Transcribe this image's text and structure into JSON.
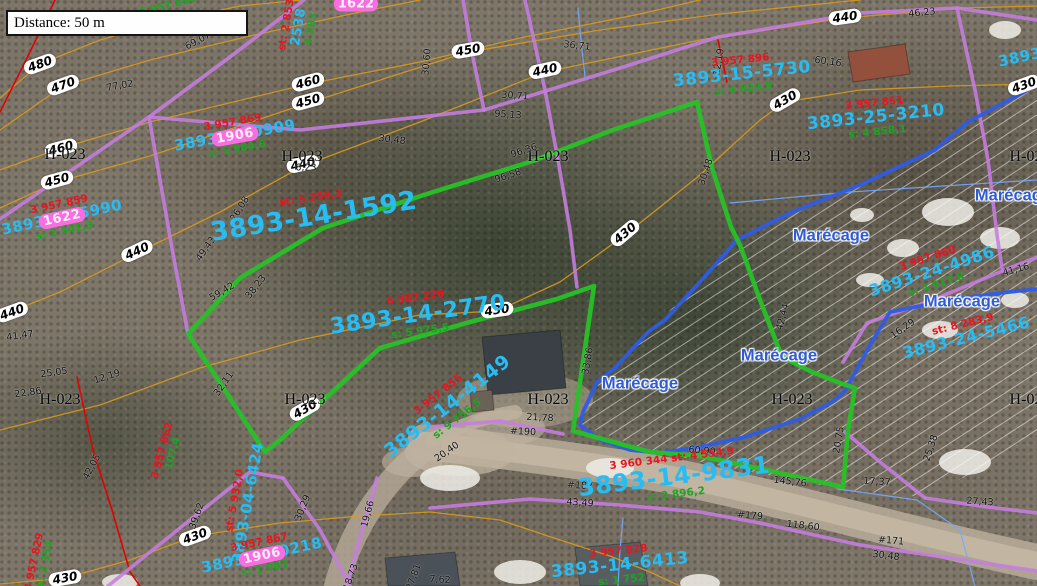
{
  "scale_box": {
    "label": "Distance: 50 m"
  },
  "map": {
    "zone_text": "H-023",
    "wetland_text": "Marécage",
    "colors": {
      "contour": "#d79a1e",
      "cadastral": "#c67de0",
      "parcel_green": "#27c127",
      "wetland_blue": "#2e5ce6",
      "stream": "#74a9ff",
      "red_line": "#e40000",
      "lot_cyan": "#27bdf4",
      "lot_red": "#ea1420",
      "area_green": "#1da522",
      "badge_pink": "#f86ee0",
      "road": "#b5a997"
    },
    "zone_labels": [
      [
        65,
        155
      ],
      [
        302,
        157
      ],
      [
        548,
        157
      ],
      [
        790,
        157
      ],
      [
        1030,
        157
      ],
      [
        60,
        400
      ],
      [
        305,
        400
      ],
      [
        548,
        400
      ],
      [
        792,
        400
      ],
      [
        1030,
        400
      ]
    ],
    "wetland_labels": [
      [
        640,
        384
      ],
      [
        779,
        356
      ],
      [
        831,
        236
      ],
      [
        962,
        302
      ],
      [
        1013,
        196
      ]
    ],
    "contour_labels": [
      [
        "480",
        40,
        64,
        -20
      ],
      [
        "480",
        163,
        22,
        -12
      ],
      [
        "470",
        63,
        85,
        -20
      ],
      [
        "460",
        308,
        82,
        -15
      ],
      [
        "460",
        61,
        148,
        -15
      ],
      [
        "450",
        468,
        50,
        -10
      ],
      [
        "450",
        308,
        101,
        -15
      ],
      [
        "450",
        57,
        180,
        -15
      ],
      [
        "440",
        845,
        17,
        -8
      ],
      [
        "440",
        545,
        70,
        -12
      ],
      [
        "440",
        303,
        164,
        -12
      ],
      [
        "440",
        137,
        251,
        -25
      ],
      [
        "440",
        12,
        312,
        -20
      ],
      [
        "430",
        785,
        100,
        -30
      ],
      [
        "430",
        625,
        233,
        -40
      ],
      [
        "430",
        497,
        310,
        -8
      ],
      [
        "430",
        305,
        409,
        -30
      ],
      [
        "430",
        195,
        536,
        -20
      ],
      [
        "430",
        65,
        578,
        -10
      ],
      [
        "430",
        1024,
        85,
        -20
      ]
    ],
    "measure_labels": [
      [
        "69,07",
        198,
        41,
        -28
      ],
      [
        "77,02",
        120,
        86,
        -10
      ],
      [
        "36,71",
        577,
        46,
        6
      ],
      [
        "30,71",
        515,
        96,
        4
      ],
      [
        "95,13",
        508,
        115,
        4
      ],
      [
        "30,48",
        392,
        140,
        7
      ],
      [
        "30,60",
        427,
        62,
        -85
      ],
      [
        "46,23",
        922,
        13,
        -6
      ],
      [
        "60,16",
        828,
        62,
        8
      ],
      [
        "12,19",
        719,
        62,
        -80
      ],
      [
        "30,48",
        706,
        172,
        -72
      ],
      [
        "96,36",
        524,
        151,
        -18
      ],
      [
        "96,58",
        508,
        176,
        -18
      ],
      [
        "6,23",
        306,
        168,
        0
      ],
      [
        "26,08",
        240,
        209,
        -58
      ],
      [
        "49,43",
        206,
        249,
        -55
      ],
      [
        "38,23",
        256,
        287,
        -52
      ],
      [
        "59,42",
        222,
        292,
        -30
      ],
      [
        "41,47",
        20,
        336,
        -8
      ],
      [
        "25,05",
        54,
        373,
        -8
      ],
      [
        "12,19",
        107,
        377,
        -18
      ],
      [
        "22,86",
        28,
        393,
        -8
      ],
      [
        "32,11",
        224,
        384,
        -55
      ],
      [
        "42,05",
        92,
        467,
        -62
      ],
      [
        "39,62",
        197,
        516,
        -70
      ],
      [
        "30,29",
        303,
        508,
        -68
      ],
      [
        "19,66",
        368,
        514,
        -75
      ],
      [
        "18,73",
        351,
        577,
        -70
      ],
      [
        "27,81",
        414,
        577,
        -70
      ],
      [
        "43,49",
        580,
        503,
        4
      ],
      [
        "21,78",
        540,
        418,
        3
      ],
      [
        "#190",
        523,
        432,
        3
      ],
      [
        "20,40",
        447,
        452,
        -35
      ],
      [
        "33,86",
        588,
        361,
        -80
      ],
      [
        "60,90",
        702,
        451,
        5
      ],
      [
        "145,76",
        790,
        482,
        7
      ],
      [
        "17,37",
        877,
        482,
        4
      ],
      [
        "27,43",
        980,
        502,
        4
      ],
      [
        "118,60",
        803,
        526,
        7
      ],
      [
        "30,48",
        886,
        556,
        7
      ],
      [
        "#171",
        891,
        541,
        5
      ],
      [
        "#187",
        580,
        486,
        4
      ],
      [
        "#179",
        750,
        516,
        4
      ],
      [
        "20,75",
        839,
        440,
        -80
      ],
      [
        "25,38",
        931,
        448,
        -72
      ],
      [
        "41,16",
        1016,
        270,
        -16
      ],
      [
        "16,29",
        903,
        329,
        -35
      ],
      [
        "42,44",
        783,
        317,
        -75
      ],
      [
        "7,62",
        440,
        580,
        4
      ]
    ],
    "parcel_labels": [
      {
        "x": 313,
        "y": 212,
        "rot": -9,
        "size": 26,
        "red": "st: 5 258,3",
        "cyan": "3893-14-1592"
      },
      {
        "x": 418,
        "y": 315,
        "rot": -8,
        "size": 22,
        "red": "6 387 226",
        "cyan": "3893-14-2770",
        "green": "s: 5 975,5"
      },
      {
        "x": 448,
        "y": 407,
        "rot": -38,
        "size": 19,
        "red": "3 957 855",
        "cyan": "3893-14-4149",
        "green": "s: 9 756,5"
      },
      {
        "x": 674,
        "y": 477,
        "rot": -7,
        "size": 24,
        "red": "3 960 344   st: 4 554,9",
        "cyan": "3893-14-9831",
        "green": "s: 2 896,2"
      },
      {
        "x": 620,
        "y": 566,
        "rot": -6,
        "size": 17,
        "red": "3 957 828",
        "cyan": "3893-14-6413",
        "green": "s: 1 752"
      },
      {
        "x": 742,
        "y": 75,
        "rot": -6,
        "size": 17,
        "red": "3 957 896",
        "cyan": "3893-15-5730",
        "green": "s: 4 929,9"
      },
      {
        "x": 876,
        "y": 118,
        "rot": -6,
        "size": 17,
        "red": "3 957 851",
        "cyan": "3893-25-3210",
        "green": "s: 4 858,1"
      },
      {
        "x": 932,
        "y": 272,
        "rot": -18,
        "size": 16,
        "red": "3 957 860",
        "cyan": "3893-24-4986",
        "green": "s: 4 917,8"
      },
      {
        "x": 965,
        "y": 333,
        "rot": -14,
        "size": 16,
        "red": "st: 8 283,9",
        "cyan": "3893-24-5466"
      },
      {
        "x": 243,
        "y": 502,
        "rot": -80,
        "size": 15,
        "red": "st: 5 932,0",
        "cyan": "3893-04-6424"
      },
      {
        "x": 62,
        "y": 218,
        "rot": -12,
        "size": 15,
        "red": "3 957 859",
        "cyan": "3893-04-5990",
        "green": "s: 2 341,3",
        "badge": "1622"
      },
      {
        "x": 235,
        "y": 136,
        "rot": -10,
        "size": 15,
        "red": "3 957 869",
        "cyan": "3893-15-0909",
        "green": "s: 5 984,6",
        "badge": "1906"
      },
      {
        "x": 262,
        "y": 556,
        "rot": -12,
        "size": 15,
        "red": "3 957 867",
        "cyan": "3893-05-0218",
        "green": "s: 1 083",
        "badge": "1906"
      },
      {
        "x": 299,
        "y": 27,
        "rot": -80,
        "size": 13,
        "red": "st: 2 853",
        "cyan": "2538",
        "green": "4 283"
      },
      {
        "x": 356,
        "y": 3,
        "rot": 0,
        "size": 13,
        "badge": "1622"
      },
      {
        "x": 1020,
        "y": 58,
        "rot": -12,
        "size": 15,
        "cyan": "3893"
      },
      {
        "x": 168,
        "y": 452,
        "rot": -75,
        "size": 11,
        "red": "3 957 862",
        "green": "107,4"
      },
      {
        "x": 40,
        "y": 563,
        "rot": -78,
        "size": 11,
        "red": "3 957 829",
        "green": "s: 2 354"
      },
      {
        "x": 168,
        "y": 6,
        "rot": -15,
        "size": 11,
        "green": "3 957 888"
      }
    ],
    "lines": {
      "contours": [
        "0,98 40,64 100,40 163,22 240,6 302,0",
        "0,130 63,86 150,60 250,36 360,12 420,0",
        "0,170 61,148 150,122 308,84 420,62 520,38 640,14 700,0",
        "0,208 57,182 150,156 308,103 468,52 600,30 720,14 860,0",
        "0,316 60,292 137,253 220,212 303,166 420,122 545,72 700,40 845,18 960,8 1037,6",
        "0,430 100,405 200,368 300,340 420,315 497,311 560,282 625,235 700,175 760,120 785,102 860,90 950,86 1037,84",
        "0,584 65,578 130,560 195,536 280,523 360,516 430,512 500,520 560,540 610,556 650,572 680,586"
      ],
      "red": [
        "0,112 28,56 55,0",
        "718,40 727,82",
        "77,377 93,450 112,510 130,572 140,586"
      ],
      "streams": [
        "578,8 581,40 585,77",
        "730,203 850,192 1037,180",
        "623,518 620,550 618,586",
        "838,489 917,500 960,530 975,586"
      ],
      "cadastral": [
        "0,219 149,117 238,51 304,0",
        "149,117 171,243 188,334",
        "463,0 473,58 484,110",
        "149,117 300,130 484,110 620,68 718,37 860,13 957,8 1037,20",
        "957,8 975,90 988,160 997,235 1002,268",
        "525,0 545,90 558,160 570,230 577,287",
        "430,427 500,421 563,434",
        "108,586 180,528 250,472 283,478",
        "283,478 320,530 350,586",
        "377,478 362,530 347,586",
        "430,508 530,499 620,505 700,512 760,523 860,545 950,558 1037,571",
        "845,432 880,462 925,498",
        "925,498 980,506 1037,513",
        "843,362 867,323 935,299 1000,272 1037,257"
      ],
      "wetland": [
        "1037,85 968,122 935,150 860,185 790,213 737,240 700,282 665,320 648,332 615,368 597,382 583,412 580,425 600,440 630,450 660,453 700,447 745,437 800,419 832,402 845,391 870,345 890,312 950,300 1000,293 1037,289"
      ],
      "green": [
        "188,334 240,278 323,228 430,193 533,161 610,131 697,102 712,168 731,227 740,245 760,300 782,357 812,372 840,383 855,388 848,430 843,487 780,473 700,456 650,452 573,431 594,286 557,299 470,322 380,348 280,440 265,452 188,334"
      ]
    },
    "hatch_polygon": "737,240 935,150 1037,85 1037,440 925,497 845,490 660,454 580,425 600,381 648,331 700,282",
    "roads": [
      {
        "d": "M425,442 C480,448 560,458 650,472 C760,492 880,528 1037,562",
        "w": 36,
        "c": "#b5a997",
        "o": 0.9
      },
      {
        "d": "M425,442 C480,448 560,458 650,472 C760,492 880,528 1037,562",
        "w": 20,
        "c": "#c4b8a5",
        "o": 0.9
      },
      {
        "d": "M430,445 C392,472 354,520 336,586",
        "w": 24,
        "c": "#b2a694",
        "o": 0.85
      },
      {
        "d": "M432,440 C462,424 488,416 515,412",
        "w": 14,
        "c": "#beb29f",
        "o": 0.8
      }
    ],
    "clearings": [
      [
        460,
        452,
        55,
        24,
        0.75
      ],
      [
        505,
        428,
        40,
        18,
        0.6
      ],
      [
        412,
        462,
        30,
        15,
        0.6
      ],
      [
        525,
        400,
        68,
        28,
        0.45
      ]
    ],
    "houses": [
      {
        "pts": "482,337 560,330 566,388 488,395",
        "f": "#3a4045"
      },
      {
        "pts": "848,52 905,44 910,74 853,82",
        "f": "#92503d"
      },
      {
        "pts": "385,558 455,552 460,586 388,586",
        "f": "#4a5158"
      },
      {
        "pts": "575,548 640,542 648,586 580,586",
        "f": "#585d60"
      },
      {
        "pts": "470,392 492,390 494,410 472,412",
        "f": "#6b6257"
      }
    ],
    "snow": [
      [
        948,
        212,
        26,
        14
      ],
      [
        1000,
        238,
        20,
        11
      ],
      [
        903,
        248,
        16,
        9
      ],
      [
        862,
        215,
        12,
        7
      ],
      [
        610,
        468,
        24,
        10
      ],
      [
        450,
        478,
        30,
        13
      ],
      [
        520,
        572,
        26,
        12
      ],
      [
        700,
        583,
        20,
        9
      ],
      [
        965,
        462,
        26,
        13
      ],
      [
        1015,
        300,
        14,
        8
      ],
      [
        940,
        330,
        18,
        9
      ],
      [
        120,
        582,
        18,
        8
      ],
      [
        870,
        280,
        14,
        7
      ],
      [
        1005,
        30,
        16,
        9
      ]
    ]
  }
}
